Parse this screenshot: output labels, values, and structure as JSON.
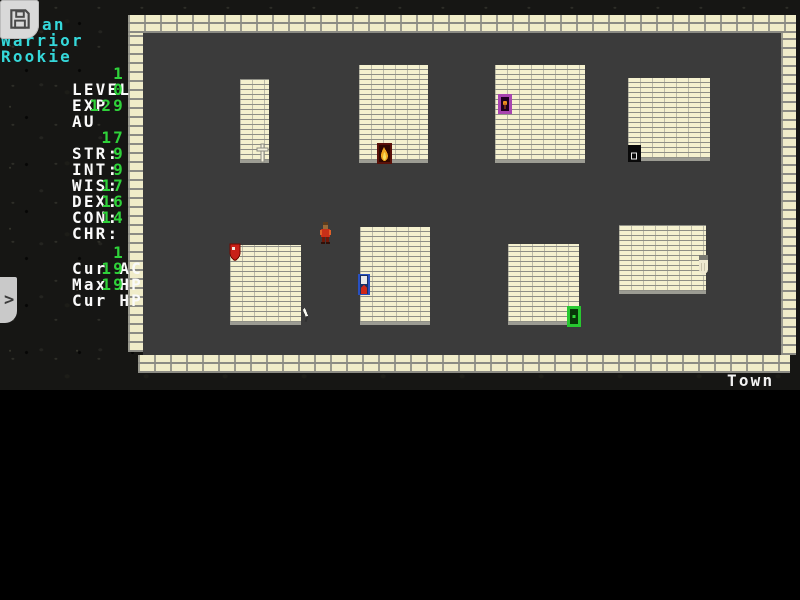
{
  "colors": {
    "cyan": "#35d8da",
    "stat_green": "#2fd23a",
    "text_white": "#fafafa",
    "floor_gray": "#3b3b3b",
    "brick_cream": "#f0ecc9",
    "mortar_gray": "#8b8b84"
  },
  "sidebar": {
    "save_button_icon": "floppy-disk-icon",
    "name_visible": "an",
    "class_label": "Warrior",
    "title_label": "Rookie",
    "info_rows": [
      {
        "label": "LEVEL",
        "value": "1"
      },
      {
        "label": "EXP",
        "value": "0"
      },
      {
        "label": "AU",
        "value": "129"
      }
    ],
    "stat_rows": [
      {
        "label": "STR:",
        "value": "17"
      },
      {
        "label": "INT:",
        "value": "9"
      },
      {
        "label": "WIS:",
        "value": "9"
      },
      {
        "label": "DEX:",
        "value": "17"
      },
      {
        "label": "CON:",
        "value": "16"
      },
      {
        "label": "CHR:",
        "value": "14"
      }
    ],
    "vitals_rows": [
      {
        "label": "Cur AC",
        "value": "1"
      },
      {
        "label": "Max HP",
        "value": "19"
      },
      {
        "label": "Cur HP",
        "value": "19"
      }
    ],
    "expand_chevron": ">"
  },
  "map": {
    "location_label": "Town",
    "buildings": [
      "building-1",
      "building-2",
      "building-3",
      "building-4",
      "building-5",
      "building-6",
      "building-7",
      "building-8"
    ],
    "entities": [
      {
        "icon": "temple-cross-icon",
        "color": "#f6f3de"
      },
      {
        "icon": "flame-door-icon",
        "color": "#5a1008"
      },
      {
        "icon": "purple-door-icon",
        "color": "#a844b0"
      },
      {
        "icon": "black-door-icon",
        "color": "#0a0a0a"
      },
      {
        "icon": "red-shield-door-icon",
        "color": "#c82018"
      },
      {
        "icon": "dagger-icon",
        "color": "#f8f8f0"
      },
      {
        "icon": "player-character-icon",
        "color": "#c83018"
      },
      {
        "icon": "blue-door-icon",
        "color": "#2850c0"
      },
      {
        "icon": "green-door-icon",
        "color": "#28c830"
      },
      {
        "icon": "white-glove-icon",
        "color": "#eee8cf"
      }
    ]
  }
}
